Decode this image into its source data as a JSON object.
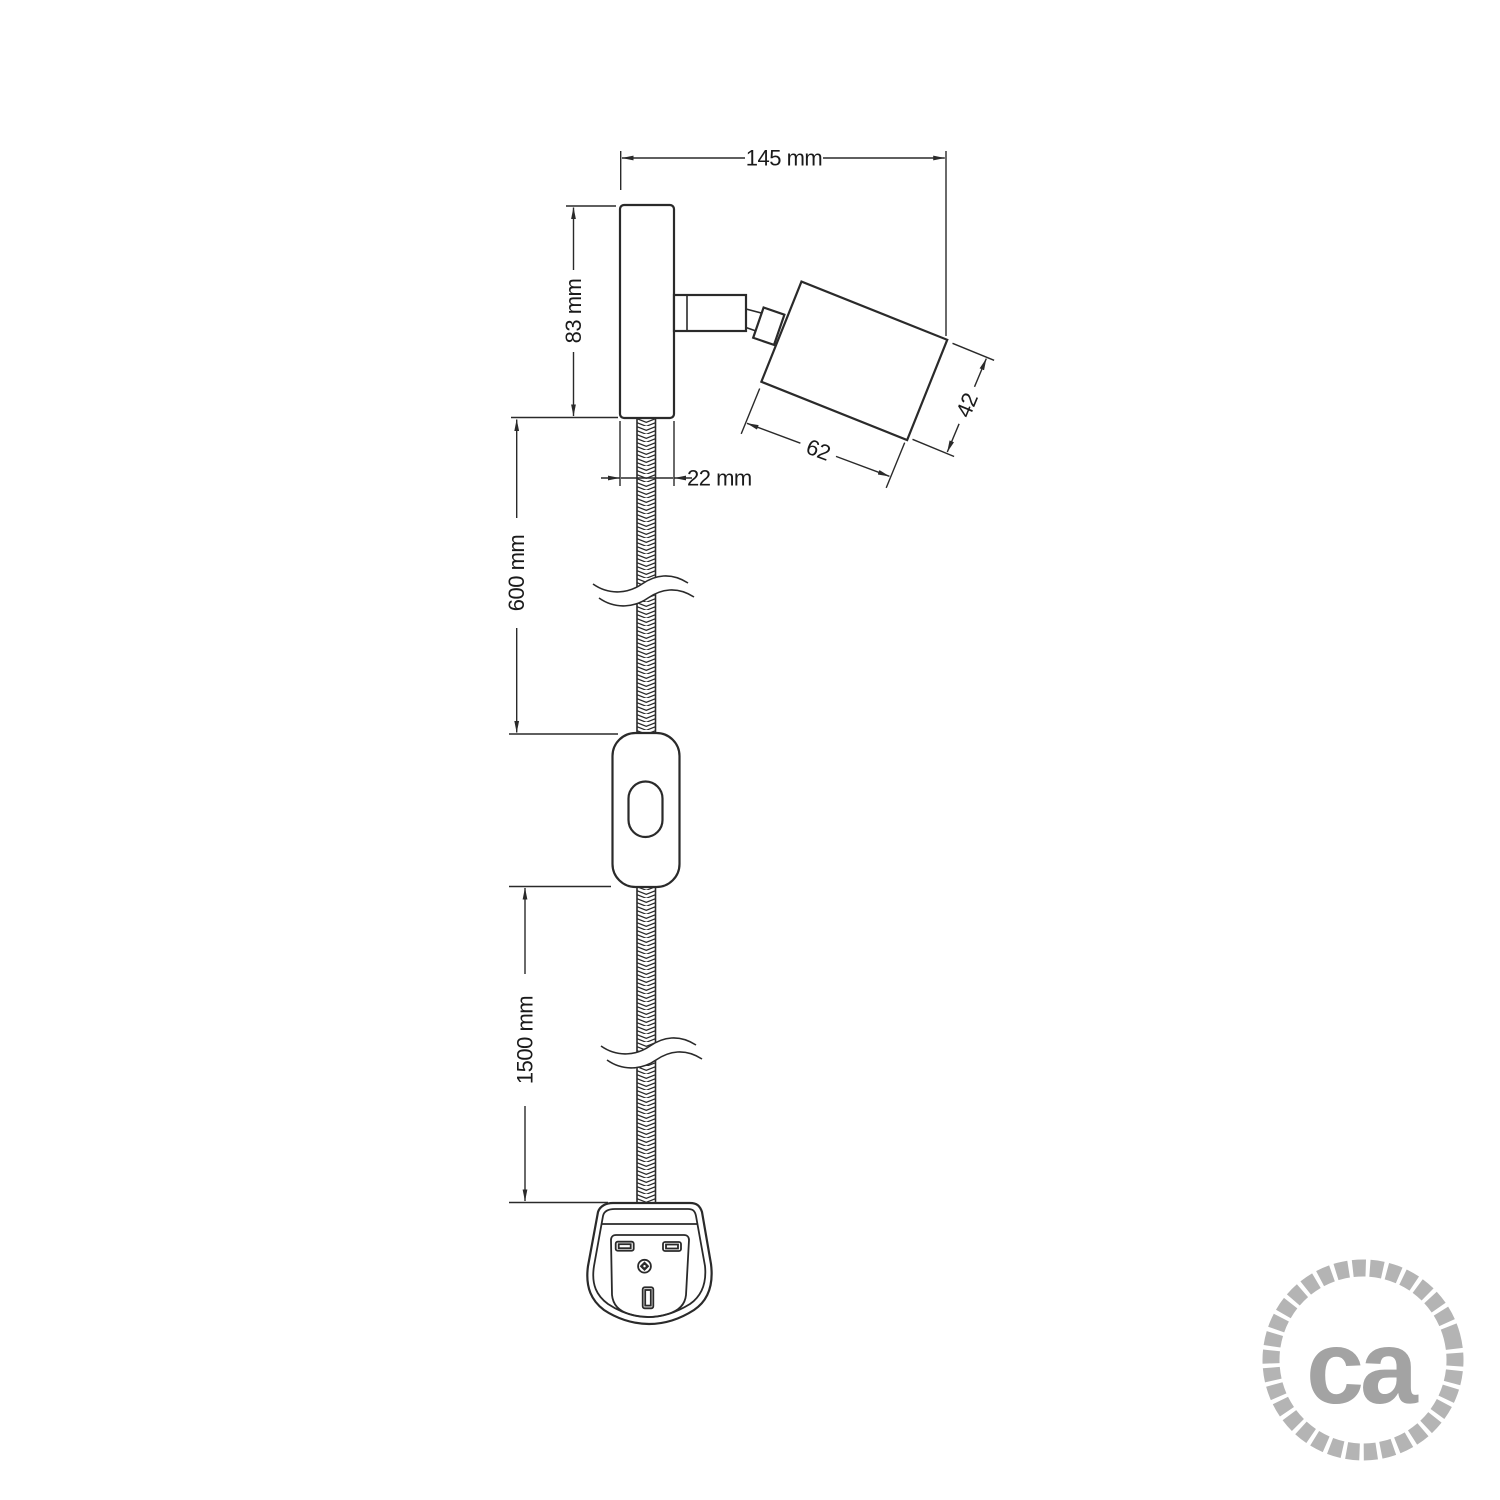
{
  "drawing": {
    "labels": {
      "overall_width": "145 mm",
      "plate_height": "83 mm",
      "plate_width": "22 mm",
      "spot_length": "62",
      "spot_diameter": "42",
      "upper_cable_length": "600 mm",
      "lower_cable_length": "1500 mm"
    },
    "colors": {
      "line": "#2a2a2a",
      "text": "#1a1a1a",
      "background": "#ffffff"
    }
  },
  "logo": {
    "text": "ca",
    "rope_color": "#b4b4b4",
    "text_color": "#a3a3a3"
  }
}
